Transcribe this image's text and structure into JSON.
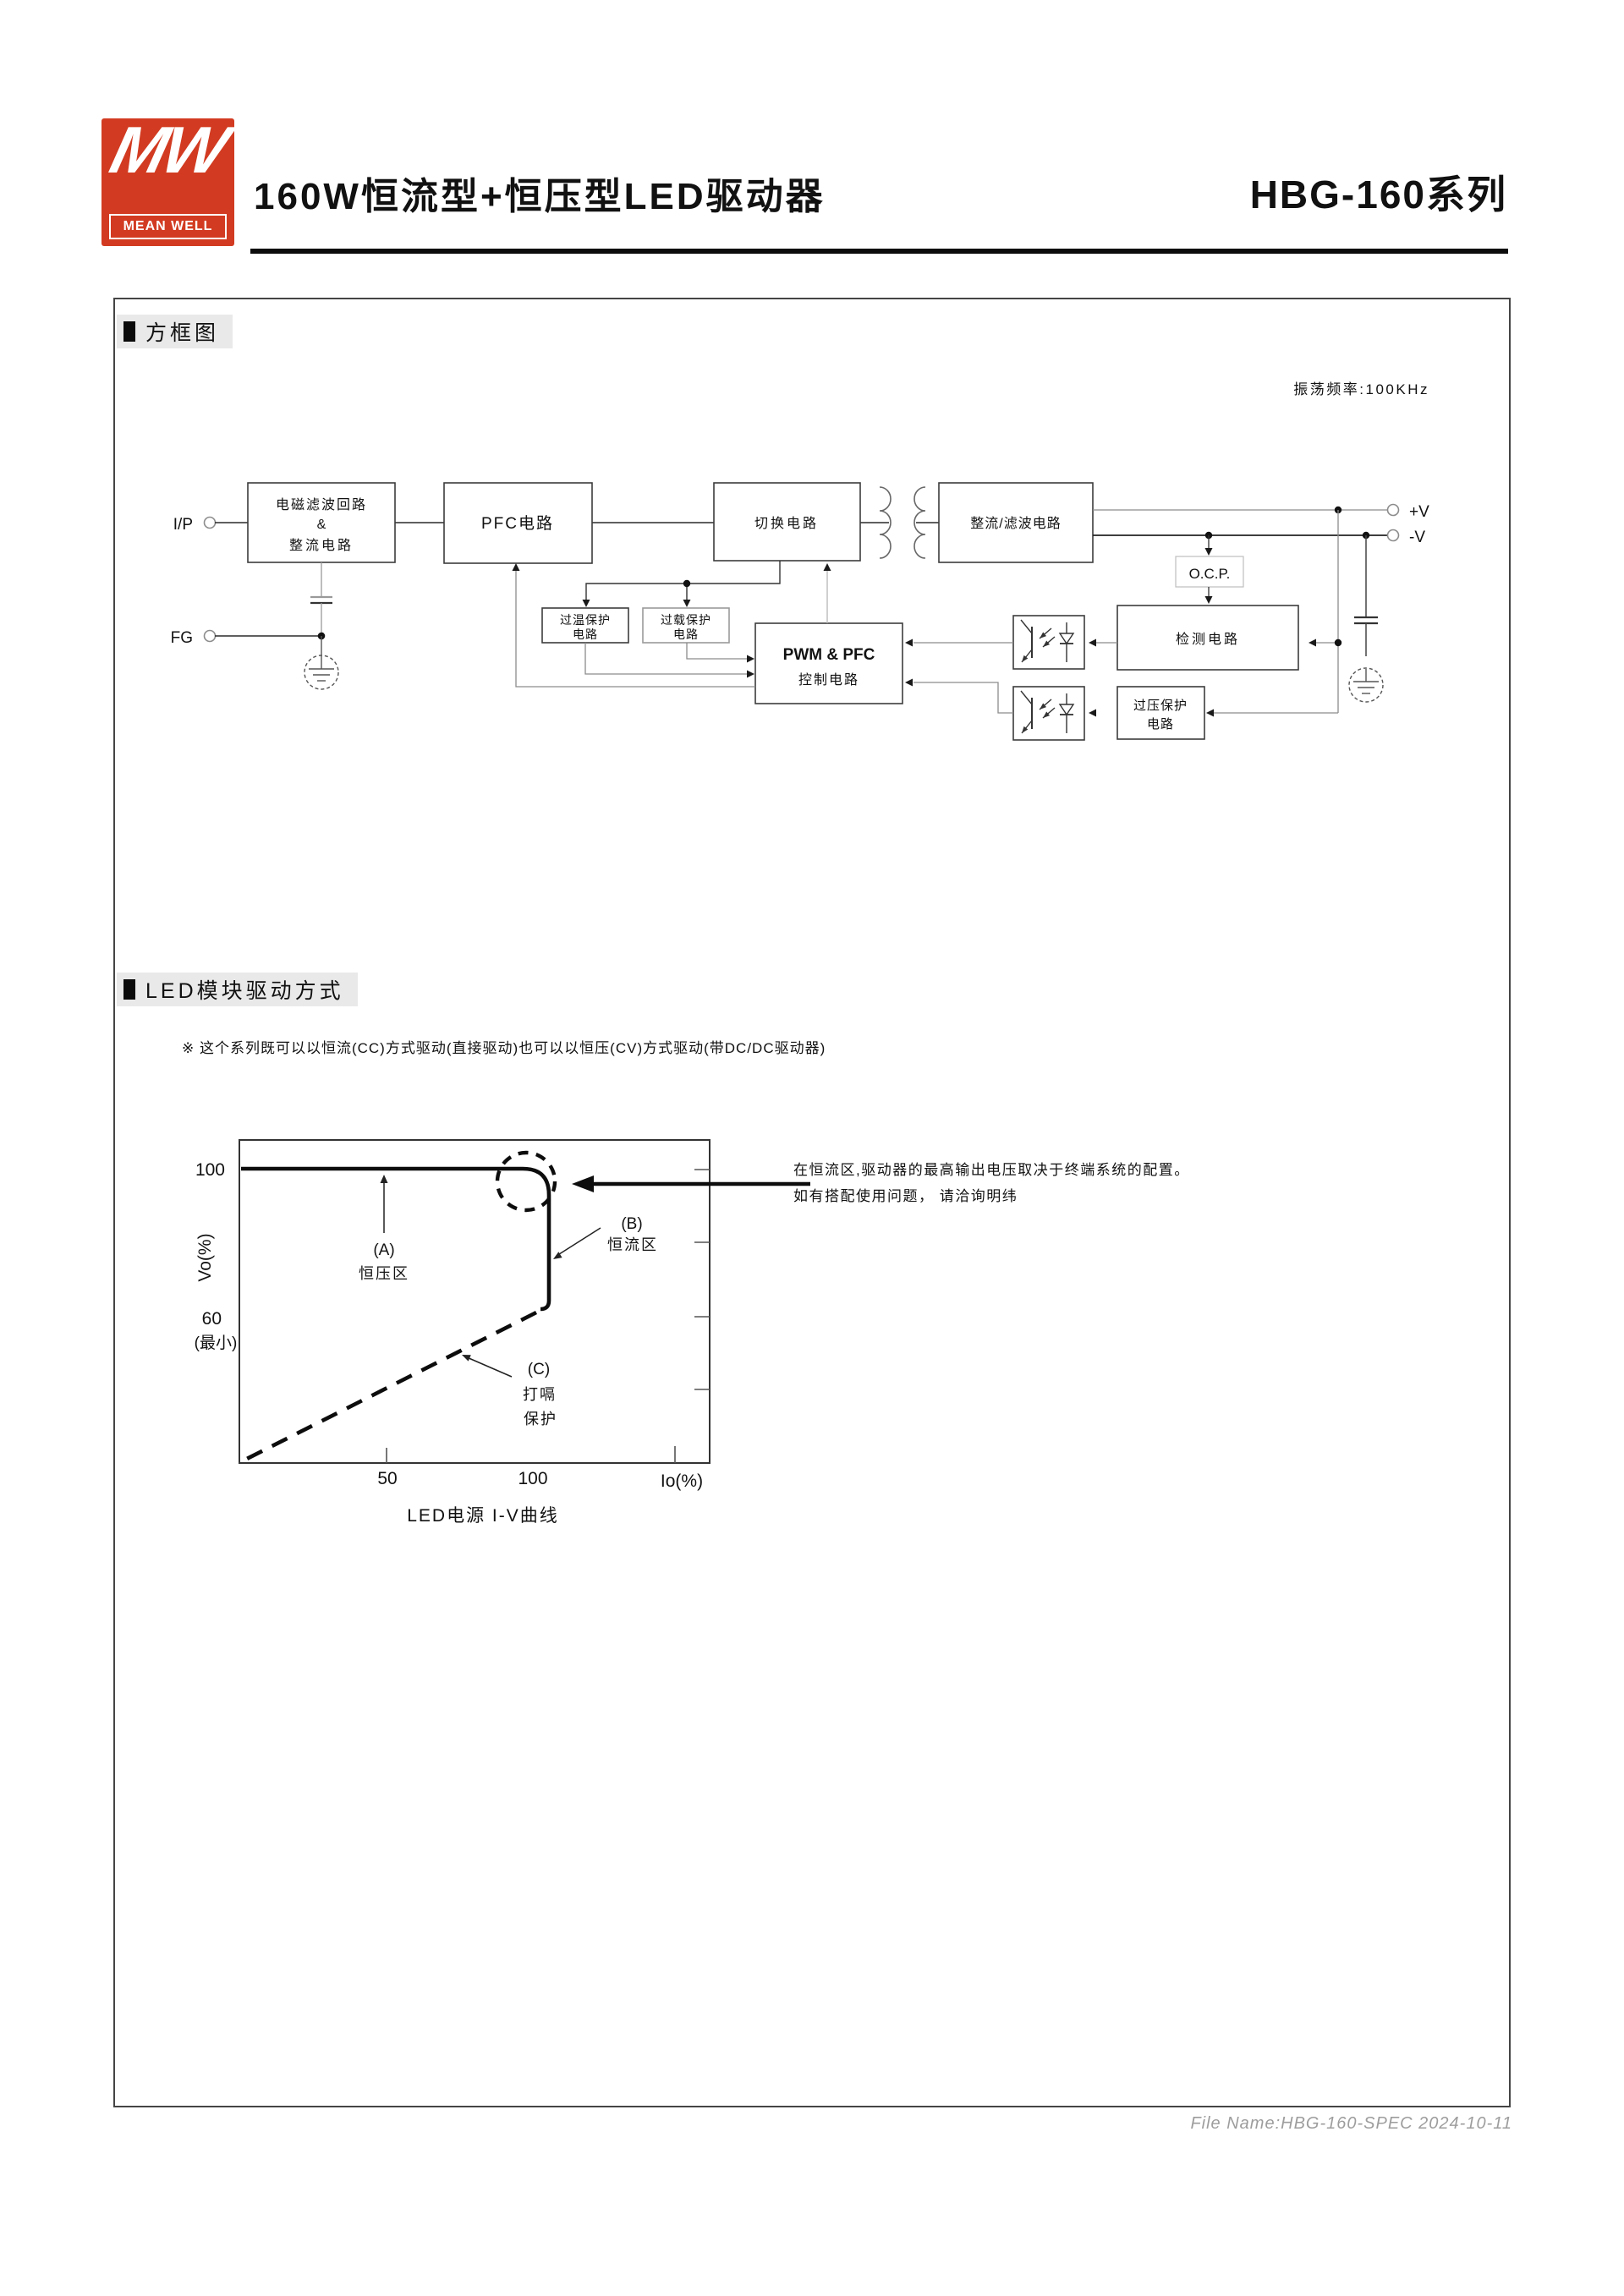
{
  "header": {
    "logo_mw": "MW",
    "logo_text": "MEAN WELL",
    "title": "160W恒流型+恒压型LED驱动器",
    "series": "HBG-160系列"
  },
  "sections": {
    "block_diagram_title": "方框图",
    "led_drive_title": "LED模块驱动方式"
  },
  "block_diagram": {
    "osc_freq": "振荡频率:100KHz",
    "terminals": {
      "input": "I/P",
      "ground": "FG",
      "v_plus": "+V",
      "v_minus": "-V"
    },
    "blocks": {
      "emi_l1": "电磁滤波回路",
      "emi_l2": "&",
      "emi_l3": "整流电路",
      "pfc": "PFC电路",
      "switching": "切换电路",
      "rectifier_filter": "整流/滤波电路",
      "otp_l1": "过温保护",
      "otp_l2": "电路",
      "olp_l1": "过载保护",
      "olp_l2": "电路",
      "pwm_l1": "PWM & PFC",
      "pwm_l2": "控制电路",
      "ocp": "O.C.P.",
      "detection": "检测电路",
      "ovp_l1": "过压保护",
      "ovp_l2": "电路"
    }
  },
  "led_drive": {
    "note": "※ 这个系列既可以以恒流(CC)方式驱动(直接驱动)也可以以恒压(CV)方式驱动(带DC/DC驱动器)",
    "annotation_l1": "在恒流区,驱动器的最高输出电压取决于终端系统的配置。",
    "annotation_l2": "如有搭配使用问题， 请洽询明纬",
    "chart_labels": {
      "y_100": "100",
      "y_60": "60",
      "y_min": "(最小)",
      "y_axis": "Vo(%)",
      "x_50": "50",
      "x_100": "100",
      "x_axis": "Io(%)",
      "a_tag": "(A)",
      "a_name": "恒压区",
      "b_tag": "(B)",
      "b_name": "恒流区",
      "c_tag": "(C)",
      "c_name_l1": "打嗝",
      "c_name_l2": "保护",
      "caption": "LED电源 I-V曲线"
    }
  },
  "chart_data": {
    "type": "line",
    "title": "LED电源 I-V曲线",
    "xlabel": "Io(%)",
    "ylabel": "Vo(%)",
    "x_ticks": [
      50,
      100
    ],
    "y_ticks": [
      60,
      100
    ],
    "y_tick_labels": [
      "60 (最小)",
      "100"
    ],
    "xlim": [
      0,
      160
    ],
    "ylim": [
      20,
      108
    ],
    "grid": false,
    "series": [
      {
        "name": "恒压区(A)/恒流区(B)工作曲线",
        "style": "solid",
        "points": [
          [
            0,
            100
          ],
          [
            100,
            100
          ],
          [
            105,
            97
          ],
          [
            105,
            62
          ]
        ]
      },
      {
        "name": "打嗝保护(C)",
        "style": "dashed",
        "points": [
          [
            104,
            62
          ],
          [
            1,
            21
          ]
        ]
      }
    ],
    "annotations": [
      {
        "label": "(A) 恒压区",
        "x": 50,
        "y": 100
      },
      {
        "label": "(B) 恒流区",
        "x": 105,
        "y": 80
      },
      {
        "label": "(C) 打嗝保护",
        "x": 75,
        "y": 45
      },
      {
        "label": "在恒流区,驱动器的最高输出电压取决于终端系统的配置。如有搭配使用问题， 请洽询明纬",
        "x": 105,
        "y": 100
      }
    ]
  },
  "footer": {
    "file_info": "File Name:HBG-160-SPEC  2024-10-11"
  }
}
